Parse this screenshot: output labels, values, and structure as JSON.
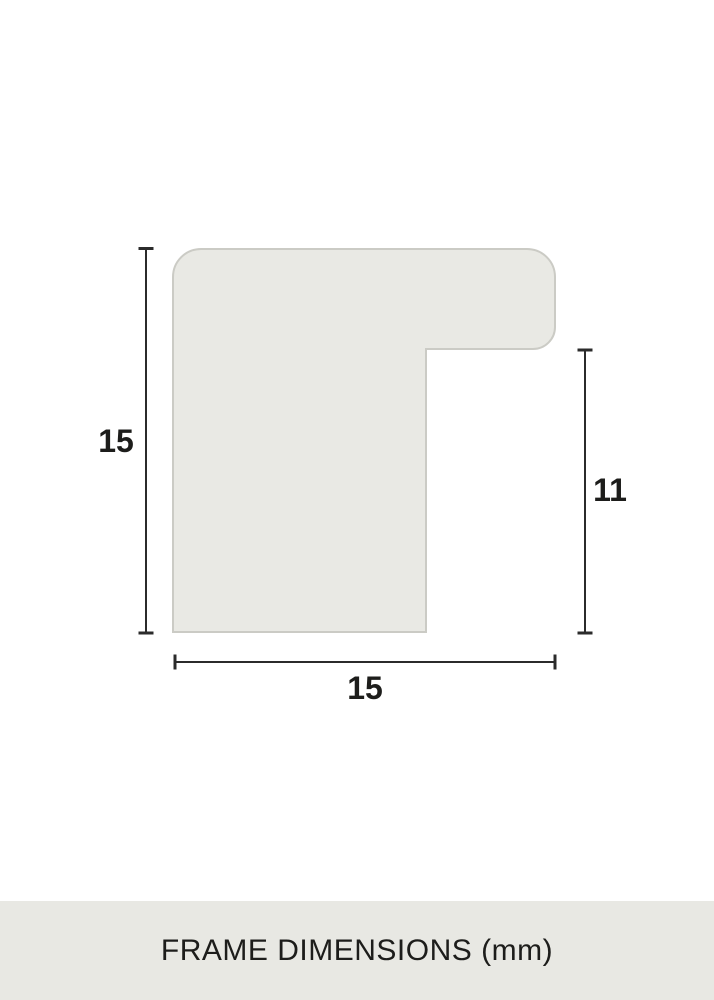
{
  "diagram": {
    "dimension_labels": {
      "left": "15",
      "right": "11",
      "bottom": "15"
    }
  },
  "footer": {
    "caption": "FRAME DIMENSIONS (mm)"
  },
  "colors": {
    "background": "#ffffff",
    "profile_fill": "#e9e9e4",
    "profile_border": "#cbcbc5",
    "dimension_line": "#2b2b2b",
    "label_text": "#1d1d1b",
    "footer_background": "#e8e8e3",
    "footer_text": "#1d1d1b"
  }
}
